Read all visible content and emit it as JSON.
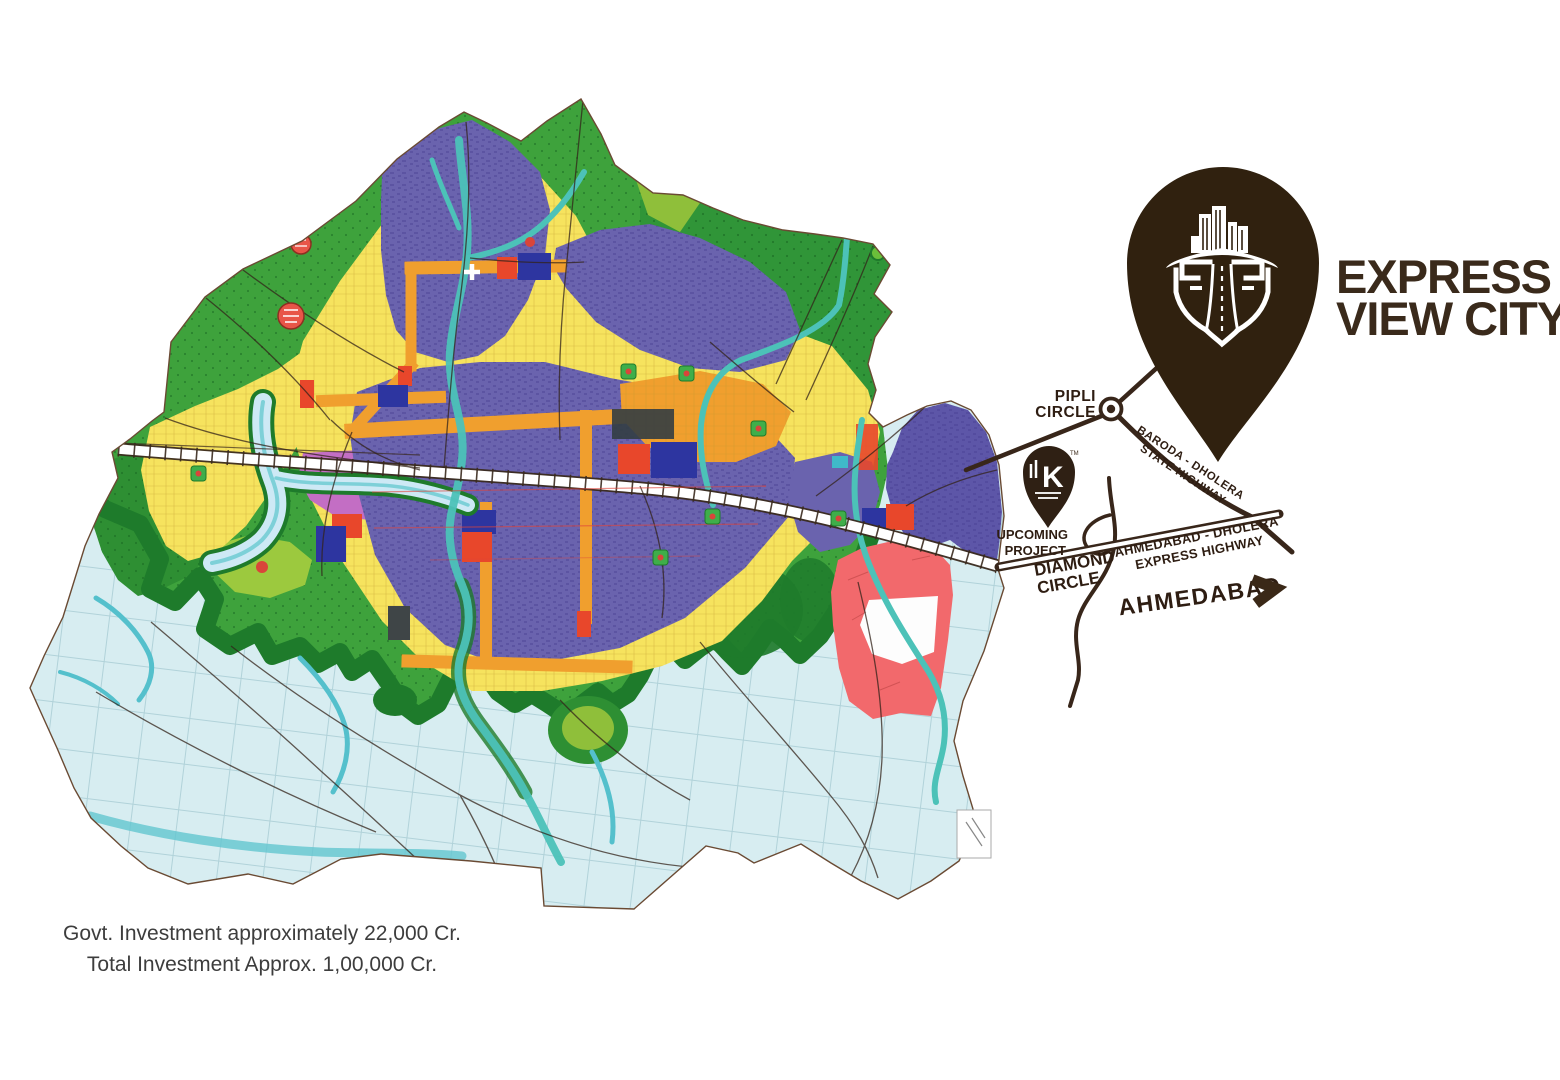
{
  "logo": {
    "line1": "EXPRESS",
    "line2": "VIEW CITY"
  },
  "diagram": {
    "pipli": [
      "PIPLI",
      "CIRCLE"
    ],
    "upcoming": [
      "UPCOMING",
      "PROJECT"
    ],
    "diamond": [
      "DIAMOND",
      "CIRCLE"
    ],
    "state_highway": [
      "BARODA - DHOLERA",
      "STATE HIGHWAY"
    ],
    "express_highway": [
      "AHMEDABAD - DHOLERA",
      "EXPRESS HIGHWAY"
    ],
    "destination": "AHMEDABAD",
    "small_pin_letter": "K",
    "small_pin_tm": "TM"
  },
  "footer": {
    "line1": "Govt. Investment approximately 22,000 Cr.",
    "line2": "Total Investment Approx. 1,00,000 Cr."
  },
  "colors": {
    "pin_dark_brown": "#30210f",
    "road_brown": "#38261a",
    "label_brown": "#2e1d12",
    "map_light_blue": "#d7edf1",
    "map_green": "#3ea23c",
    "map_dark_green": "#1e7b2b",
    "map_lime": "#9cc93e",
    "map_yellow": "#f6e35e",
    "map_orange": "#f09f2e",
    "map_purple": "#6a63ae",
    "map_navy": "#2d35a0",
    "map_red": "#e8472b",
    "map_magenta": "#c36ec4",
    "map_salmon": "#f2696c",
    "map_river_teal": "#4cc2b8"
  }
}
